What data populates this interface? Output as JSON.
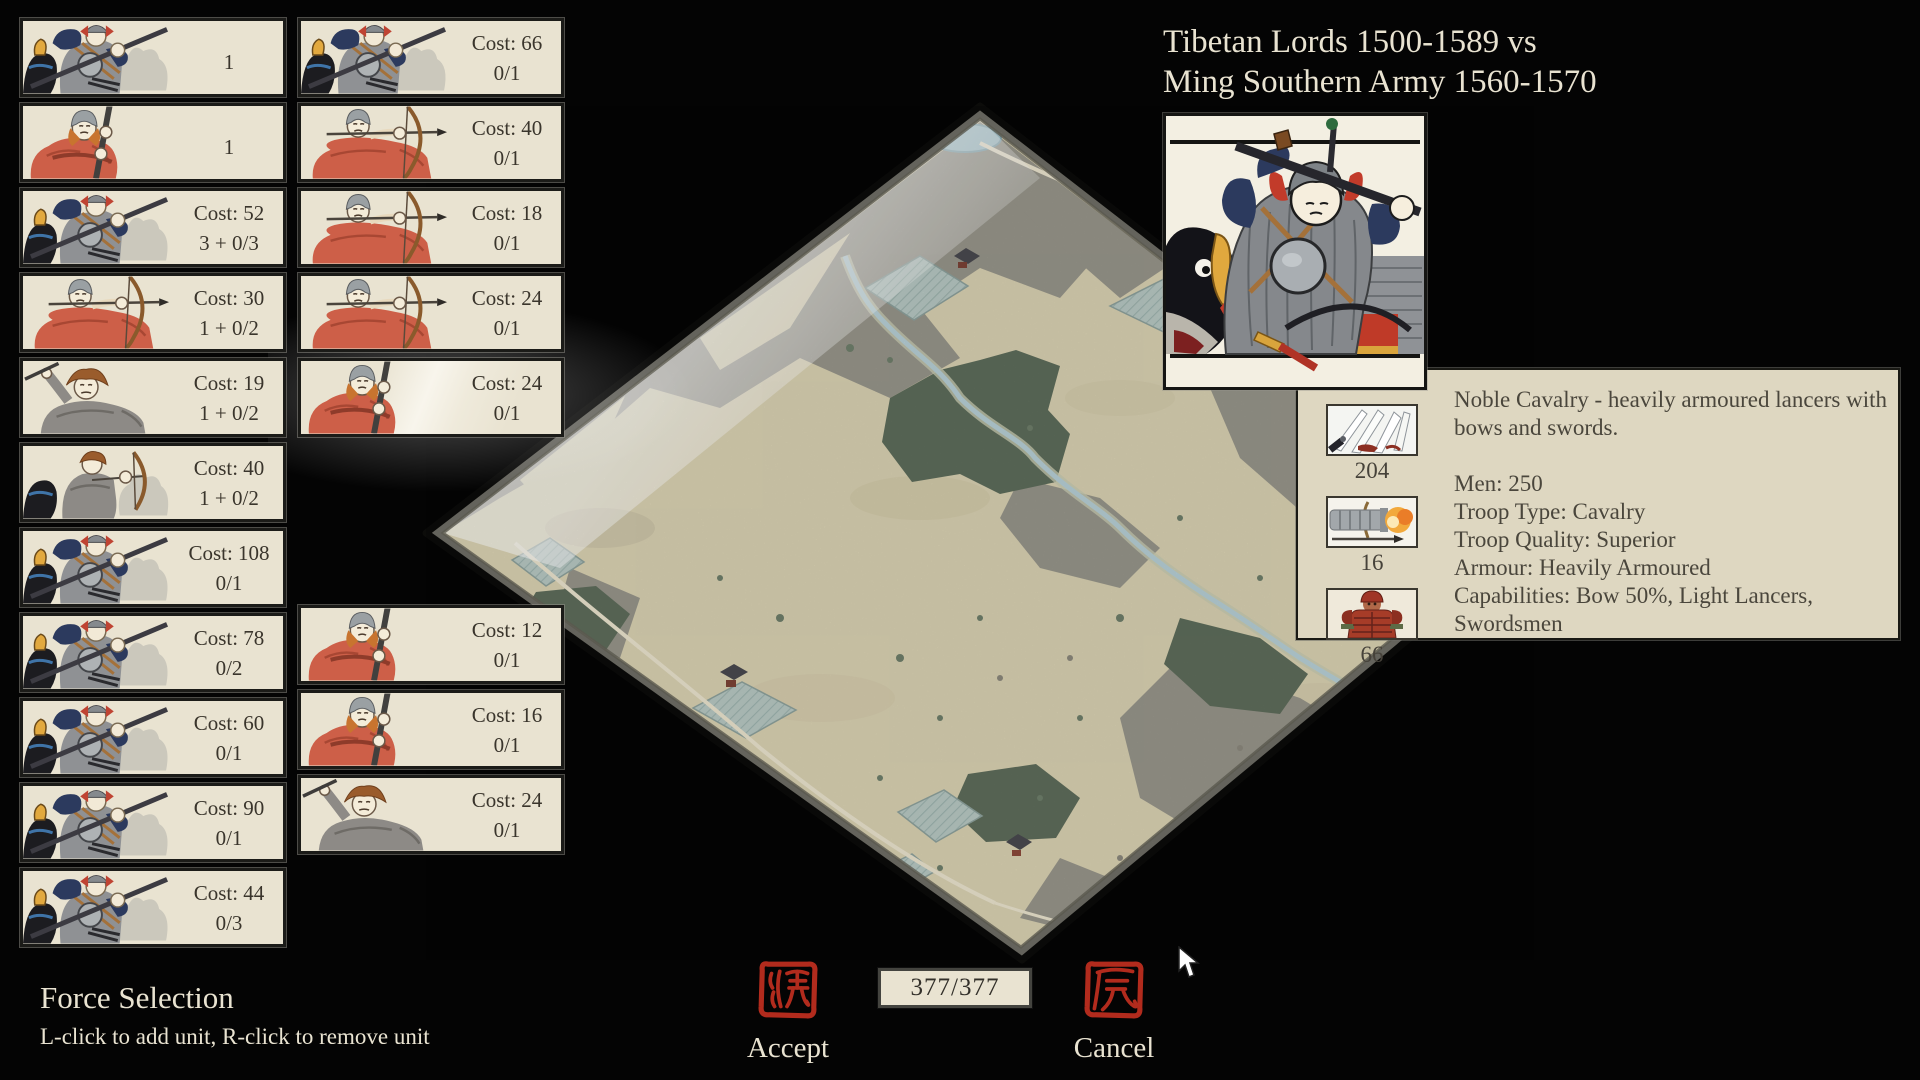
{
  "header": {
    "title_line1": "Tibetan Lords 1500-1589 vs",
    "title_line2": "Ming Southern Army 1560-1570"
  },
  "left_cards": [
    {
      "art": "armoured-lancer",
      "cost": "",
      "slots": "1"
    },
    {
      "art": "red-spearman",
      "cost": "",
      "slots": "1"
    },
    {
      "art": "armoured-lancer",
      "cost": "Cost: 52",
      "slots": "3 + 0/3"
    },
    {
      "art": "red-archer",
      "cost": "Cost: 30",
      "slots": "1 + 0/2"
    },
    {
      "art": "grey-swordsman",
      "cost": "Cost: 19",
      "slots": "1 + 0/2"
    },
    {
      "art": "grey-horse-archer",
      "cost": "Cost: 40",
      "slots": "1 + 0/2"
    },
    {
      "art": "armoured-lancer",
      "cost": "Cost: 108",
      "slots": "0/1"
    },
    {
      "art": "armoured-lancer",
      "cost": "Cost: 78",
      "slots": "0/2"
    },
    {
      "art": "armoured-lancer",
      "cost": "Cost: 60",
      "slots": "0/1"
    },
    {
      "art": "armoured-lancer",
      "cost": "Cost: 90",
      "slots": "0/1"
    },
    {
      "art": "armoured-lancer",
      "cost": "Cost: 44",
      "slots": "0/3"
    }
  ],
  "right_top": [
    {
      "art": "armoured-lancer",
      "cost": "Cost: 66",
      "slots": "0/1"
    },
    {
      "art": "red-archer",
      "cost": "Cost: 40",
      "slots": "0/1"
    },
    {
      "art": "red-archer",
      "cost": "Cost: 18",
      "slots": "0/1"
    },
    {
      "art": "red-archer",
      "cost": "Cost: 24",
      "slots": "0/1"
    },
    {
      "art": "red-spearman",
      "cost": "Cost: 24",
      "slots": "0/1"
    }
  ],
  "right_bottom": [
    {
      "art": "red-spearman",
      "cost": "Cost: 12",
      "slots": "0/1"
    },
    {
      "art": "red-spearman",
      "cost": "Cost: 16",
      "slots": "0/1"
    },
    {
      "art": "grey-swordsman",
      "cost": "Cost: 24",
      "slots": "0/1"
    }
  ],
  "tooltip": {
    "description": "Noble Cavalry - heavily armoured lancers with bows and swords.",
    "stats": [
      "Men: 250",
      "Troop Type: Cavalry",
      "Troop Quality: Superior",
      "Armour: Heavily Armoured",
      "Capabilities: Bow 50%, Light Lancers, Swordsmen"
    ],
    "icons": [
      {
        "name": "blades-icon",
        "value": "204"
      },
      {
        "name": "cannon-icon",
        "value": "16"
      },
      {
        "name": "armour-icon",
        "value": "66"
      }
    ]
  },
  "footer": {
    "title": "Force Selection",
    "hint": "L-click to add unit, R-click to remove unit"
  },
  "actions": {
    "accept": "Accept",
    "cancel": "Cancel",
    "points": "377/377"
  },
  "colors": {
    "seal_red": "#b22b1d",
    "card_bg": "#e9e3d1",
    "panel_bg": "#ded7c1",
    "cream_text": "#e9e3d1",
    "map_sand": "#dcd4b4",
    "map_rock": "#99978c",
    "map_forest": "#5f6e5c",
    "map_field": "#b9cac5"
  }
}
